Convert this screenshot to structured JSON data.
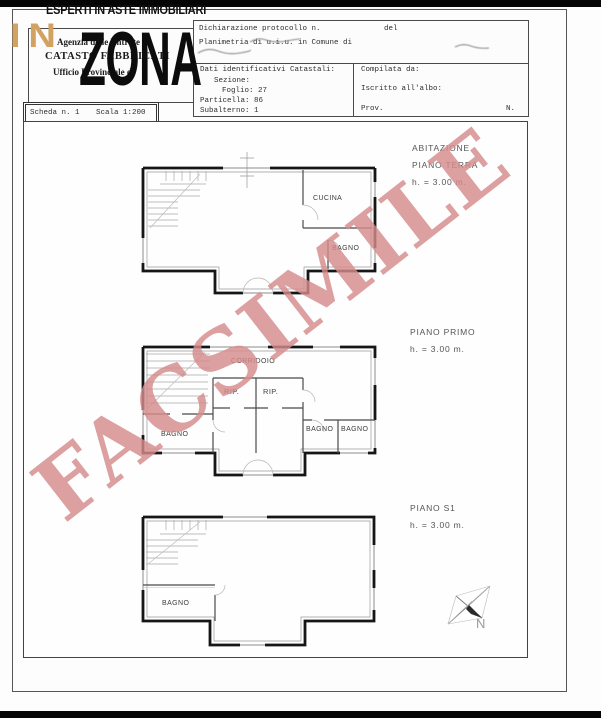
{
  "brand": {
    "tagline": "ESPERTI IN ASTE IMMOBILIARI",
    "logo_in": "IN",
    "logo_zona": "ZONA",
    "accent_color": "#d2a263"
  },
  "watermark": {
    "text": "FACSIMILE",
    "color": "#d68c8c"
  },
  "form": {
    "agency": {
      "line1": "Agenzia delle Entrate",
      "line2": "CATASTO FABBRICATI",
      "line3": "Ufficio Provinciale di"
    },
    "declaration": {
      "protocol": "Dichiarazione protocollo n.",
      "del": "del",
      "planimetria": "Planimetria di u.i.u. in Comune di"
    },
    "cadastral": {
      "title": "Dati identificativi Catastali:",
      "sezione": "Sezione:",
      "foglio": "Foglio: 27",
      "particella": "Particella: 86",
      "subalterno": "Subalterno: 1"
    },
    "compiler": {
      "compilata": "Compilata da:",
      "iscritto": "Iscritto all'albo:",
      "prov": "Prov.",
      "n": "N."
    },
    "scheda": {
      "scheda": "Scheda n. 1",
      "scala": "Scala 1:200"
    }
  },
  "plans": {
    "terra": {
      "title1": "ABITAZIONE",
      "title2": "PIANO TERRA",
      "height": "h. = 3.00 m.",
      "room_cucina": "CUCINA",
      "room_bagno": "BAGNO"
    },
    "primo": {
      "title1": "PIANO PRIMO",
      "height": "h. = 3.00 m.",
      "room_corridoio": "CORRIDOIO",
      "room_rip1": "RIP.",
      "room_rip2": "RIP.",
      "room_bagno_sw": "BAGNO",
      "room_bagno_r1": "BAGNO",
      "room_bagno_r2": "BAGNO"
    },
    "s1": {
      "title1": "PIANO S1",
      "height": "h. = 3.00 m.",
      "room_bagno": "BAGNO"
    }
  },
  "compass": {
    "label": "N"
  }
}
